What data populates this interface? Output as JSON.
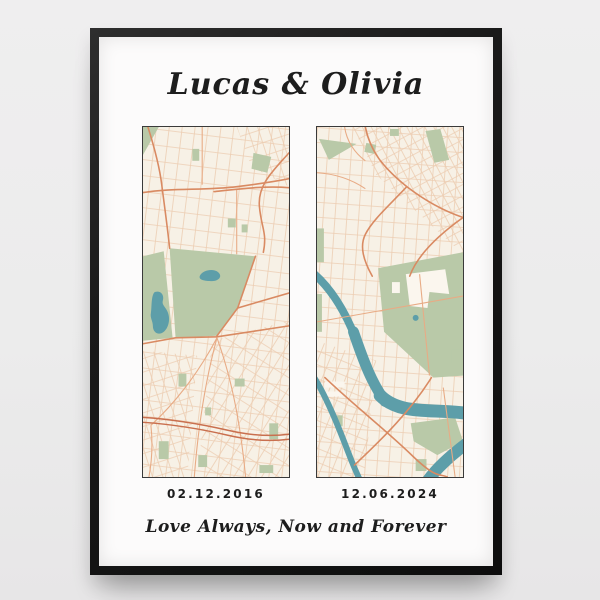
{
  "poster": {
    "title": "Lucas & Olivia",
    "message": "Love Always, Now and Forever",
    "maps": [
      {
        "id": "map-left",
        "date": "02.12.2016"
      },
      {
        "id": "map-right",
        "date": "12.06.2024"
      }
    ]
  },
  "colors": {
    "wall": "#ececec",
    "frame": "#1a1a1a",
    "matte": "#fcfbfb",
    "map-bg": "#f7f1e6",
    "map-border": "#3a3a3a",
    "road-minor": "#edcdb2",
    "road-mid": "#e8ab85",
    "road-major": "#d98a62",
    "road-dark": "#c96f4e",
    "park": "#b9c9a8",
    "water": "#5d9ea9",
    "building": "#fbf6ee",
    "text": "#1d1d1d"
  }
}
